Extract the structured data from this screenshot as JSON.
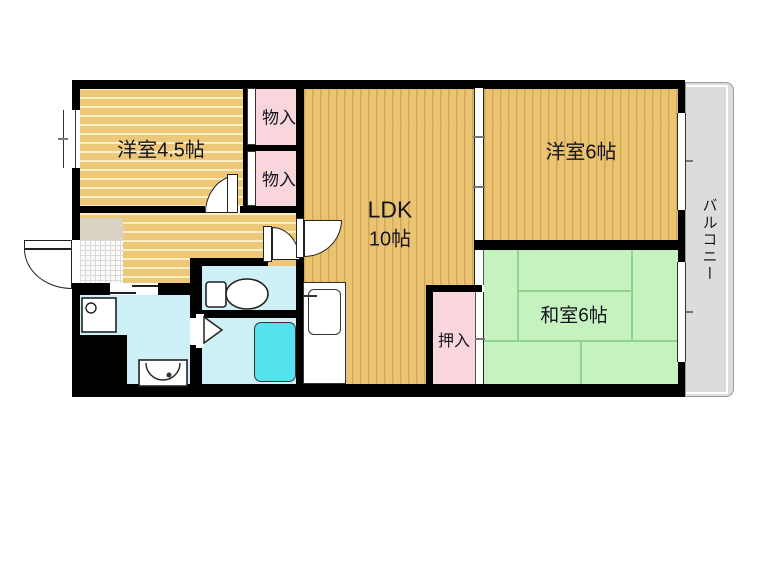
{
  "rooms": {
    "western_4_5": {
      "label": "洋室4.5帖"
    },
    "closet_upper": {
      "label": "物入"
    },
    "closet_lower": {
      "label": "物入"
    },
    "ldk": {
      "line1": "LDK",
      "line2": "10帖"
    },
    "western_6": {
      "label": "洋室6帖"
    },
    "washitsu_6": {
      "label": "和室6帖"
    },
    "oshiire": {
      "label": "押入"
    },
    "balcony": {
      "label": "バルコニー"
    }
  },
  "colors": {
    "wall": "#000000",
    "wood_floor": "#ecc878",
    "tatami_green": "#c6f2bf",
    "tatami_line": "#8fd48f",
    "closet_pink": "#f9d6db",
    "wet_area_blue": "#cdf1f6",
    "bathtub_cyan": "#55e2ef",
    "balcony_gray": "#dcdcdc",
    "genkan_step": "#d8d1c4"
  }
}
